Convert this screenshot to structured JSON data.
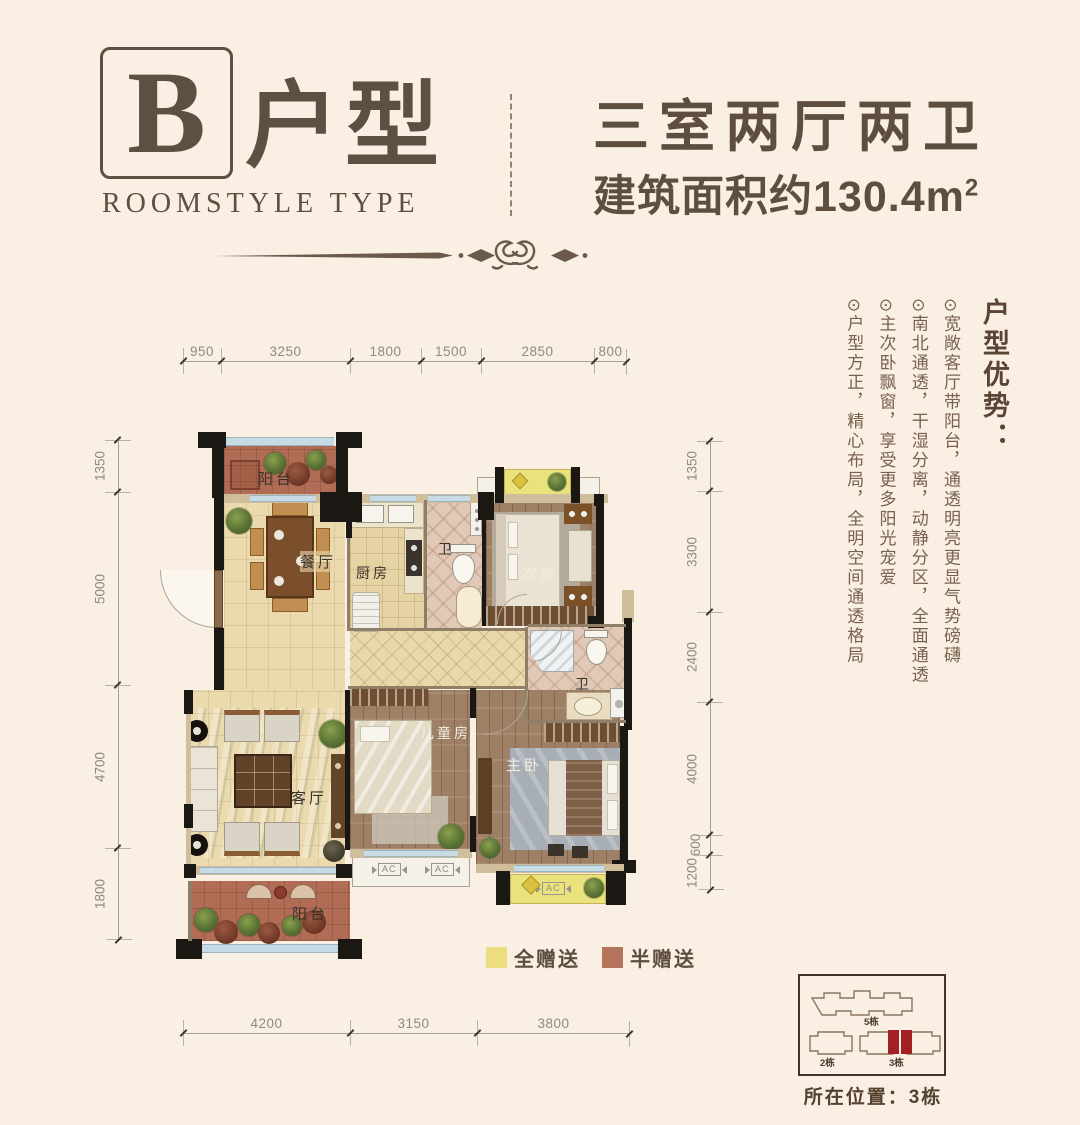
{
  "header": {
    "letter": "B",
    "type_label": "户型",
    "subtitle": "ROOMSTYLE TYPE",
    "rooms_title": "三室两厅两卫",
    "area_text": "建筑面积约130.4m",
    "area_sup": "2"
  },
  "advantages": {
    "title": "户型优势：",
    "items": [
      "⊙宽敞客厅带阳台，通透明亮更显气势磅礴",
      "⊙南北通透，干湿分离，动静分区，全面通透",
      "⊙主次卧飘窗，享受更多阳光宠爱",
      "⊙户型方正，精心布局，全明空间通透格局"
    ]
  },
  "dimensions": {
    "top": [
      "950",
      "3250",
      "1800",
      "1500",
      "2850",
      "800"
    ],
    "left": [
      "1350",
      "5000",
      "4700",
      "1800"
    ],
    "right": [
      "1350",
      "3300",
      "2400",
      "4000",
      "600",
      "1200"
    ],
    "bottom": [
      "4200",
      "3150",
      "3800"
    ]
  },
  "rooms": {
    "balcony_top": "阳台",
    "dining": "餐厅",
    "kitchen": "厨房",
    "bath1": "卫",
    "bedroom2": "次卧",
    "bath2": "卫",
    "living": "客厅",
    "kids": "儿童房",
    "master": "主卧",
    "balcony_bottom": "阳台",
    "ac_label": "AC"
  },
  "legend": {
    "full_label": "全赠送",
    "half_label": "半赠送",
    "full_color": "#ecdd7e",
    "half_color": "#b3745b"
  },
  "siteplan": {
    "building5": "5栋",
    "building2": "2栋",
    "building3": "3栋",
    "caption": "所在位置：3栋",
    "highlight_color": "#a32125"
  },
  "colors": {
    "accent_brown": "#5d4f41",
    "wall_black": "#1b1713",
    "gift_yellow": "#eae27d",
    "gift_red": "#b06c55",
    "window_blue": "#c6dbe4"
  }
}
